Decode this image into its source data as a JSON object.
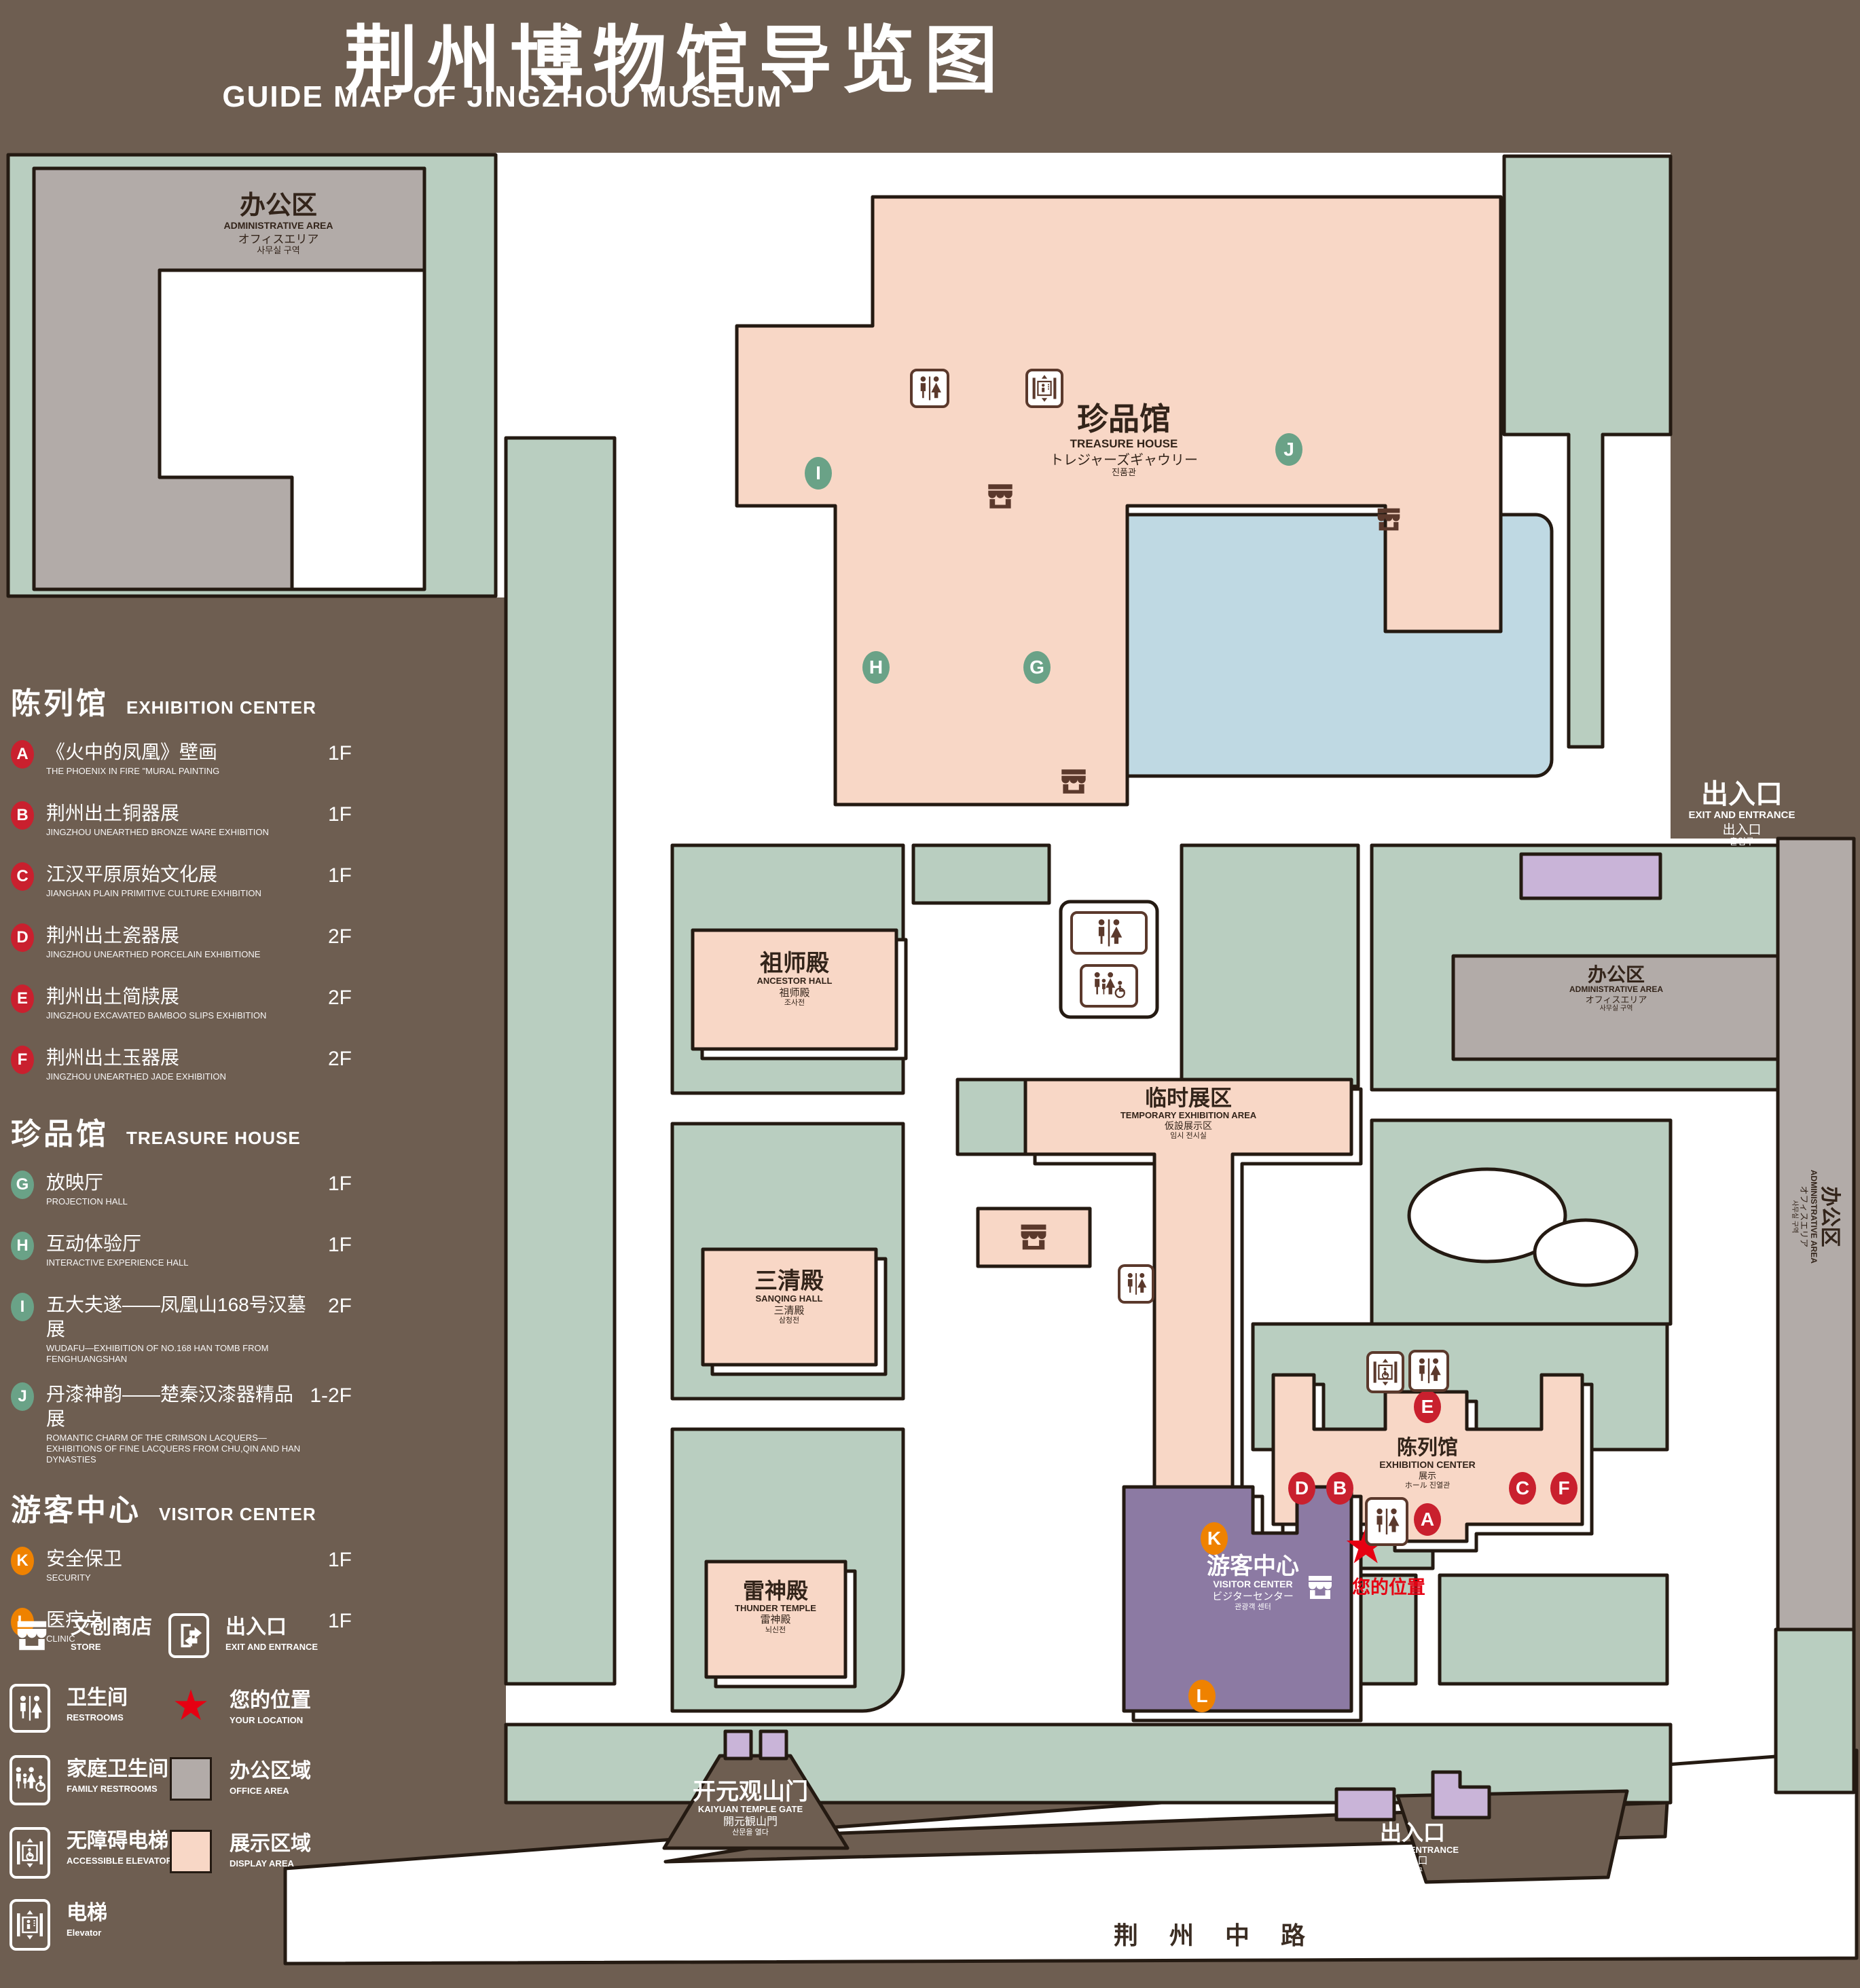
{
  "title": {
    "zh": "荆州博物馆导览图",
    "en": "GUIDE MAP OF JINGZHOU MUSEUM"
  },
  "legend": {
    "sections": [
      {
        "zh": "陈列馆",
        "en": "EXHIBITION CENTER",
        "items": [
          {
            "letter": "A",
            "zh": "《火中的凤凰》壁画",
            "en": "THE PHOENIX IN FIRE \"MURAL PAINTING",
            "floor": "1F"
          },
          {
            "letter": "B",
            "zh": "荆州出土铜器展",
            "en": "JINGZHOU UNEARTHED BRONZE WARE EXHIBITION",
            "floor": "1F"
          },
          {
            "letter": "C",
            "zh": "江汉平原原始文化展",
            "en": "JIANGHAN PLAIN PRIMITIVE CULTURE EXHIBITION",
            "floor": "1F"
          },
          {
            "letter": "D",
            "zh": "荆州出土瓷器展",
            "en": "JINGZHOU UNEARTHED PORCELAIN EXHIBITIONE",
            "floor": "2F"
          },
          {
            "letter": "E",
            "zh": "荆州出土简牍展",
            "en": "JINGZHOU EXCAVATED BAMBOO SLIPS EXHIBITION",
            "floor": "2F"
          },
          {
            "letter": "F",
            "zh": "荆州出土玉器展",
            "en": "JINGZHOU UNEARTHED JADE EXHIBITION",
            "floor": "2F"
          }
        ]
      },
      {
        "zh": "珍品馆",
        "en": "TREASURE HOUSE",
        "items": [
          {
            "letter": "G",
            "zh": "放映厅",
            "en": "PROJECTION HALL",
            "floor": "1F"
          },
          {
            "letter": "H",
            "zh": "互动体验厅",
            "en": "INTERACTIVE EXPERIENCE HALL",
            "floor": "1F"
          },
          {
            "letter": "I",
            "zh": "五大夫遂——凤凰山168号汉墓展",
            "en": "WUDAFU—EXHIBITION OF NO.168 HAN TOMB FROM FENGHUANGSHAN",
            "floor": "2F"
          },
          {
            "letter": "J",
            "zh": "丹漆神韵——楚秦汉漆器精品展",
            "en": "ROMANTIC CHARM OF THE CRIMSON LACQUERS—EXHIBITIONS OF FINE LACQUERS FROM CHU,QIN AND HAN DYNASTIES",
            "floor": "1-2F"
          }
        ]
      },
      {
        "zh": "游客中心",
        "en": "VISITOR CENTER",
        "items": [
          {
            "letter": "K",
            "zh": "安全保卫",
            "en": "SECURITY",
            "floor": "1F"
          },
          {
            "letter": "L",
            "zh": "医疗点",
            "en": "CLINIC",
            "floor": "1F"
          }
        ]
      }
    ],
    "symbols": [
      {
        "icon": "store-icon",
        "zh": "文创商店",
        "en": "STORE"
      },
      {
        "icon": "exit-icon",
        "zh": "出入口",
        "en": "EXIT AND ENTRANCE"
      },
      {
        "icon": "restrooms-icon",
        "zh": "卫生间",
        "en": "RESTROOMS"
      },
      {
        "icon": "location-star-icon",
        "zh": "您的位置",
        "en": "YOUR LOCATION"
      },
      {
        "icon": "family-restrooms-icon",
        "zh": "家庭卫生间",
        "en": "FAMILY RESTROOMS"
      },
      {
        "icon": "office-area-swatch",
        "zh": "办公区域",
        "en": "OFFICE AREA"
      },
      {
        "icon": "accessible-elevator-icon",
        "zh": "无障碍电梯",
        "en": "ACCESSIBLE ELEVATOR"
      },
      {
        "icon": "display-area-swatch",
        "zh": "展示区域",
        "en": "DISPLAY AREA"
      },
      {
        "icon": "elevator-icon",
        "zh": "电梯",
        "en": "Elevator"
      }
    ]
  },
  "map": {
    "buildings": {
      "admin": {
        "zh": "办公区",
        "en": "ADMINISTRATIVE AREA",
        "ja": "オフィスエリア",
        "ko": "사무실 구역"
      },
      "treasure_house": {
        "zh": "珍品馆",
        "en": "TREASURE HOUSE",
        "ja": "トレジャーズギャウリー",
        "ko": "진품관"
      },
      "ancestor_hall": {
        "zh": "祖师殿",
        "en": "ANCESTOR HALL",
        "ja": "祖师殿",
        "ko": "조사전"
      },
      "temporary_exhibition": {
        "zh": "临时展区",
        "en": "TEMPORARY EXHIBITION AREA",
        "ja": "仮設展示区",
        "ko": "임시 전시실"
      },
      "sanqing_hall": {
        "zh": "三清殿",
        "en": "SANQING HALL",
        "ja": "三清殿",
        "ko": "삼청전"
      },
      "thunder_temple": {
        "zh": "雷神殿",
        "en": "THUNDER TEMPLE",
        "ja": "雷神殿",
        "ko": "뇌신전"
      },
      "visitor_center": {
        "zh": "游客中心",
        "en": "VISITOR CENTER",
        "ja": "ビジターセンター",
        "ko": "관광객 센터"
      },
      "exhibition_center": {
        "zh": "陈列馆",
        "en": "EXHIBITION CENTER",
        "ja": "展示",
        "ko": "ホール 진열관"
      },
      "kaiyuan_gate": {
        "zh": "开元观山门",
        "en": "KAIYUAN TEMPLE GATE",
        "ja": "開元観山門",
        "ko": "산문을 열다"
      }
    },
    "exits": {
      "top_right": {
        "zh": "出入口",
        "en": "EXIT AND ENTRANCE",
        "ja": "出入口",
        "ko": "출입구"
      },
      "bottom": {
        "zh": "出入口",
        "en": "EXIT AND ENTRANCE",
        "ja": "出入口",
        "ko": "출입구"
      }
    },
    "road": {
      "name": "荆 州 中 路"
    },
    "your_location": {
      "zh": "您的位置"
    },
    "markers": {
      "a": "A",
      "b": "B",
      "c": "C",
      "d": "D",
      "e": "E",
      "f": "F",
      "g": "G",
      "h": "H",
      "i": "I",
      "j": "J",
      "k": "K",
      "l": "L"
    }
  },
  "colors": {
    "background": "#6e5e51",
    "green_area": "#b9cec0",
    "display_area": "#f8d7c6",
    "office_area": "#b2aba8",
    "visitor_center": "#8c7aa3",
    "entrance_pad": "#c9b4d8",
    "lake": "#bfd9e3",
    "outline": "#241a12",
    "marker_red": "#c9202e",
    "marker_green": "#6aa287",
    "marker_orange": "#ef8200",
    "location_red": "#e60012",
    "icon_brown": "#5b392c"
  }
}
